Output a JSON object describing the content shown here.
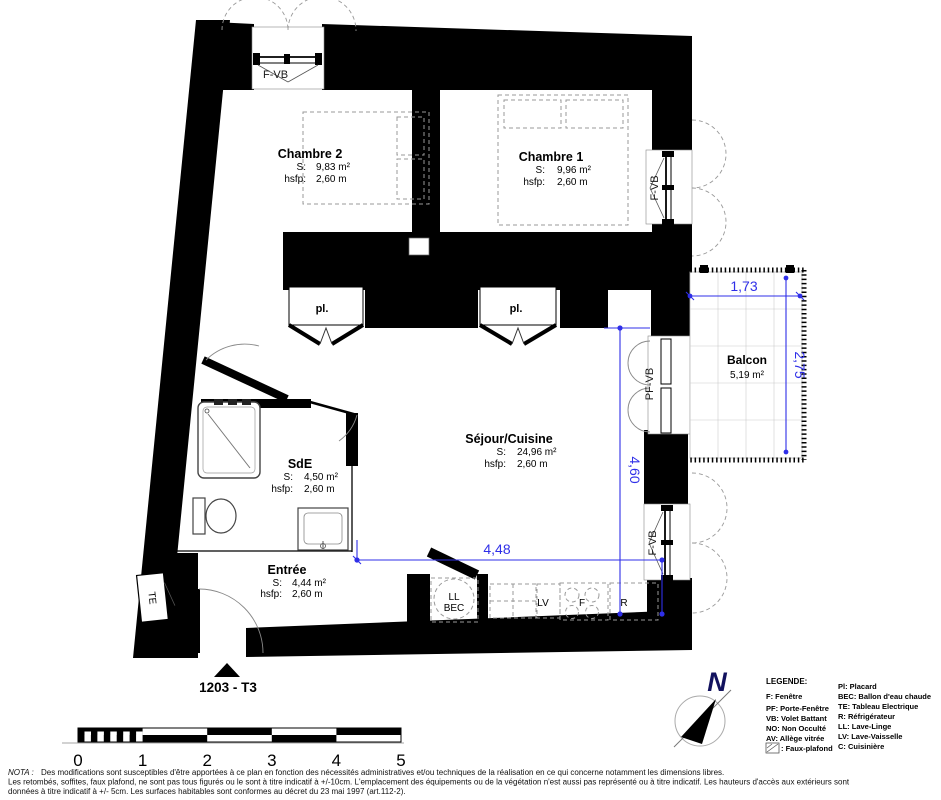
{
  "plan": {
    "unit_label": "1203 - T3",
    "north_label": "N",
    "rooms": {
      "chambre2": {
        "name": "Chambre 2",
        "skey": "S:",
        "sval": "9,83 m²",
        "hkey": "hsfp:",
        "hval": "2,60 m"
      },
      "chambre1": {
        "name": "Chambre 1",
        "skey": "S:",
        "sval": "9,96 m²",
        "hkey": "hsfp:",
        "hval": "2,60 m"
      },
      "sejour": {
        "name": "Séjour/Cuisine",
        "skey": "S:",
        "sval": "24,96 m²",
        "hkey": "hsfp:",
        "hval": "2,60 m"
      },
      "sde": {
        "name": "SdE",
        "skey": "S:",
        "sval": "4,50 m²",
        "hkey": "hsfp:",
        "hval": "2,60 m"
      },
      "entree": {
        "name": "Entrée",
        "skey": "S:",
        "sval": "4,44 m²",
        "hkey": "hsfp:",
        "hval": "2,60 m"
      },
      "balcon": {
        "name": "Balcon",
        "sval": "5,19 m²"
      }
    },
    "openings": {
      "top_window": "F-VB",
      "chambre1_window": "F-VB",
      "balcony_door": "PF-VB",
      "sejour_window": "F-VB"
    },
    "closets": {
      "pl1": "pl.",
      "pl2": "pl."
    },
    "electrical_label": "TE",
    "appliances": {
      "ll": "LL",
      "bec": "BEC",
      "lv": "LV",
      "f": "F",
      "r": "R"
    },
    "dimensions": {
      "balcony_width": "1,73",
      "balcony_depth": "2,75",
      "sejour_height": "4,60",
      "sejour_width": "4,48"
    }
  },
  "scalebar": {
    "ticks": [
      "0",
      "1",
      "2",
      "3",
      "4",
      "5"
    ]
  },
  "legend": {
    "title": "LEGENDE:",
    "left": [
      "F: Fenêtre",
      "PF: Porte-Fenêtre",
      "VB: Volet Battant",
      "NO: Non Occulté",
      "AV: Allège vitrée"
    ],
    "faux_plafond": ": Faux-plafond",
    "right": [
      "Pl: Placard",
      "BEC: Ballon d'eau chaude",
      "TE: Tableau Electrique",
      "R: Réfrigérateur",
      "LL: Lave-Linge",
      "LV: Lave-Vaisselle",
      "C: Cuisinière"
    ]
  },
  "nota": {
    "label": "NOTA :",
    "line1": "Des modifications sont susceptibles d'être apportées à ce plan en fonction des nécessités administratives et/ou techniques de la réalisation en ce qui concerne notamment les dimensions libres.",
    "line2": "Les retombés, soffites, faux plafond, ne sont pas tous figurés ou le sont à titre indicatif à +/-10cm. L'emplacement des équipements ou de la végétation n'est aussi pas représenté ou à titre indicatif. Les hauteurs d'accès aux extérieurs sont",
    "line3": "données à titre indicatif à +/- 5cm. Les surfaces habitables sont conformes au décret du 23 mai 1997 (art.112-2)."
  },
  "colors": {
    "dimension": "#2f2fe8",
    "wall": "#000000"
  }
}
